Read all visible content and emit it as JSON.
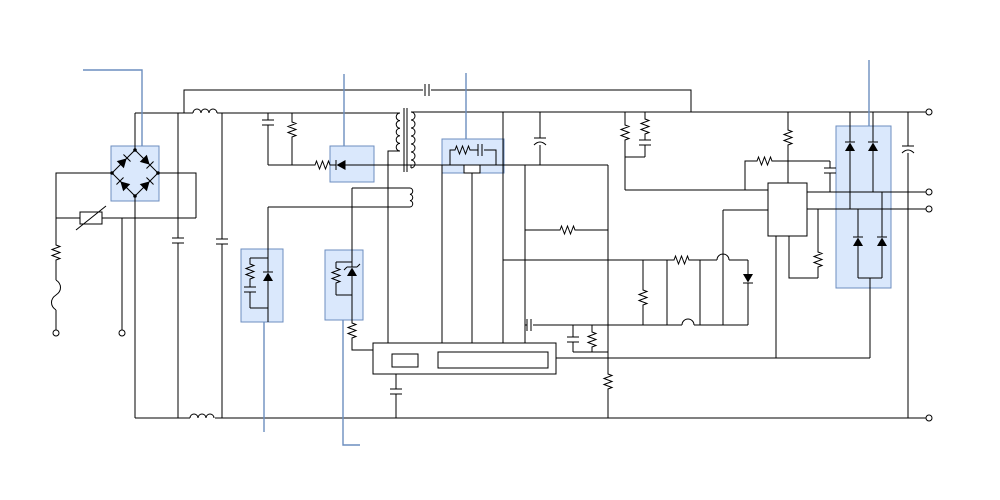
{
  "diagram": {
    "kind": "circuit-schematic",
    "subject": "switch-mode power supply schematic with highlighted components",
    "background": "#ffffff",
    "colors": {
      "wire": "#000000",
      "highlight_fill": "#dae8fc",
      "highlight_stroke": "#6c8ebf",
      "callout_stroke": "#6c8ebf",
      "terminal_fill": "#ffffff",
      "component_fill": "#ffffff"
    },
    "highlights": [
      {
        "id": "bridge-rectifier",
        "x": 111,
        "y": 146,
        "w": 48,
        "h": 55
      },
      {
        "id": "clamp-diode",
        "x": 330,
        "y": 146,
        "w": 44,
        "h": 36
      },
      {
        "id": "rc-snubber",
        "x": 442,
        "y": 139,
        "w": 62,
        "h": 34
      },
      {
        "id": "rcd-clamp",
        "x": 241,
        "y": 249,
        "w": 42,
        "h": 73
      },
      {
        "id": "shunt-regulator",
        "x": 325,
        "y": 250,
        "w": 38,
        "h": 70
      },
      {
        "id": "output-rectifier",
        "x": 836,
        "y": 126,
        "w": 55,
        "h": 162
      }
    ],
    "callouts": [
      {
        "target": "bridge-rectifier",
        "d": "M83,70 L142,70 L142,146"
      },
      {
        "target": "clamp-diode",
        "d": "M344,74 L344,146"
      },
      {
        "target": "rc-snubber",
        "d": "M466,73 L466,139"
      },
      {
        "target": "output-rectifier",
        "d": "M869,60 L869,126"
      },
      {
        "target": "rcd-clamp",
        "d": "M264,322 L264,432"
      },
      {
        "target": "shunt-regulator",
        "d": "M343,320 L343,445 L360,445"
      }
    ],
    "terminals": [
      {
        "id": "ac-input-line",
        "x": 56,
        "y": 333
      },
      {
        "id": "ac-input-neutral",
        "x": 122,
        "y": 333
      },
      {
        "id": "output-positive",
        "x": 929,
        "y": 112
      },
      {
        "id": "output-sense-1",
        "x": 929,
        "y": 192
      },
      {
        "id": "output-sense-2",
        "x": 929,
        "y": 209
      },
      {
        "id": "output-return",
        "x": 929,
        "y": 418
      }
    ],
    "components": [
      "fuse",
      "varistor",
      "series-resistor",
      "bridge-rectifier",
      "emi-filter-inductors",
      "x-capacitors",
      "rc-snubber-network",
      "clamp-series-resistor",
      "clamp-diode",
      "flyback-transformer",
      "auxiliary-winding",
      "rcd-clamp",
      "shunt-regulator",
      "pwm-controller-ic",
      "regulator-ic",
      "output-rectifier-diodes",
      "output-electrolytic-capacitor",
      "optocoupler-feedback-network"
    ]
  }
}
